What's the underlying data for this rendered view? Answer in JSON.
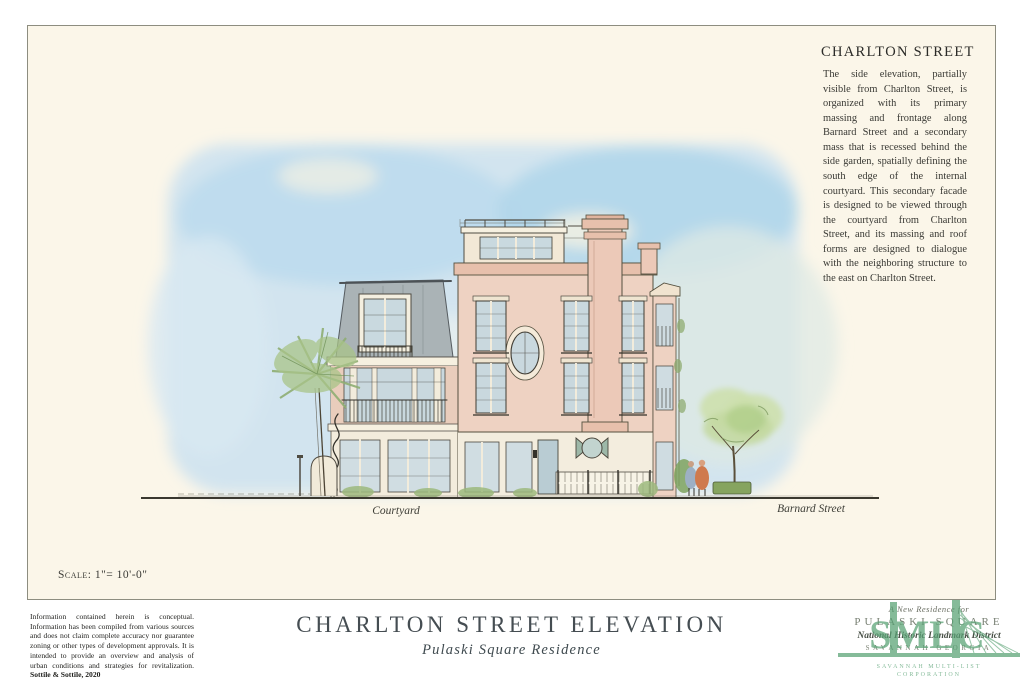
{
  "panel": {
    "heading": "CHARLTON STREET",
    "body_text": "The side elevation, partially visible from Charlton Street, is organized with its primary massing and frontage along Barnard Street and a secondary mass that is recessed behind the side garden, spatially defining the south edge of the internal courtyard. This secondary facade is designed to be viewed through the courtyard from Charlton Street, and its massing and roof forms are designed to dialogue with the neighboring structure to the east on Charlton Street.",
    "scale_note": "Scale: 1\"= 10'-0\"",
    "labels": {
      "courtyard": "Courtyard",
      "barnard_street": "Barnard Street"
    }
  },
  "footer": {
    "disclaimer_text": "Information contained herein is conceptual. Information has been compiled from various sources and does not claim complete accuracy nor guarantee zoning or other types of development approvals. It is intended to provide an overview and analysis of urban conditions and strategies for revitalization.",
    "disclaimer_credit": "Sottile & Sottile, 2020",
    "title": "CHARLTON STREET ELEVATION",
    "subtitle": "Pulaski Square Residence",
    "project_block": {
      "line1": "A New Residence for",
      "line2": "PULASKI SQUARE",
      "line3": "National Historic Landmark District",
      "line4": "SAVANNAH GEORGIA"
    },
    "watermark": {
      "initials": "SMLC",
      "caption_line1": "SAVANNAH MULTI-LIST",
      "caption_line2": "CORPORATION"
    }
  },
  "colors": {
    "paper": "#fbf6e9",
    "sky_wash": "#bedcee",
    "building_pink": "#eed2c2",
    "roof_gray": "#aab3b6",
    "glass": "#c9d8de",
    "foliage": "#b3cf8d",
    "ink": "#3c3b33",
    "title_text": "#454d52",
    "watermark_green": "#57a173"
  }
}
